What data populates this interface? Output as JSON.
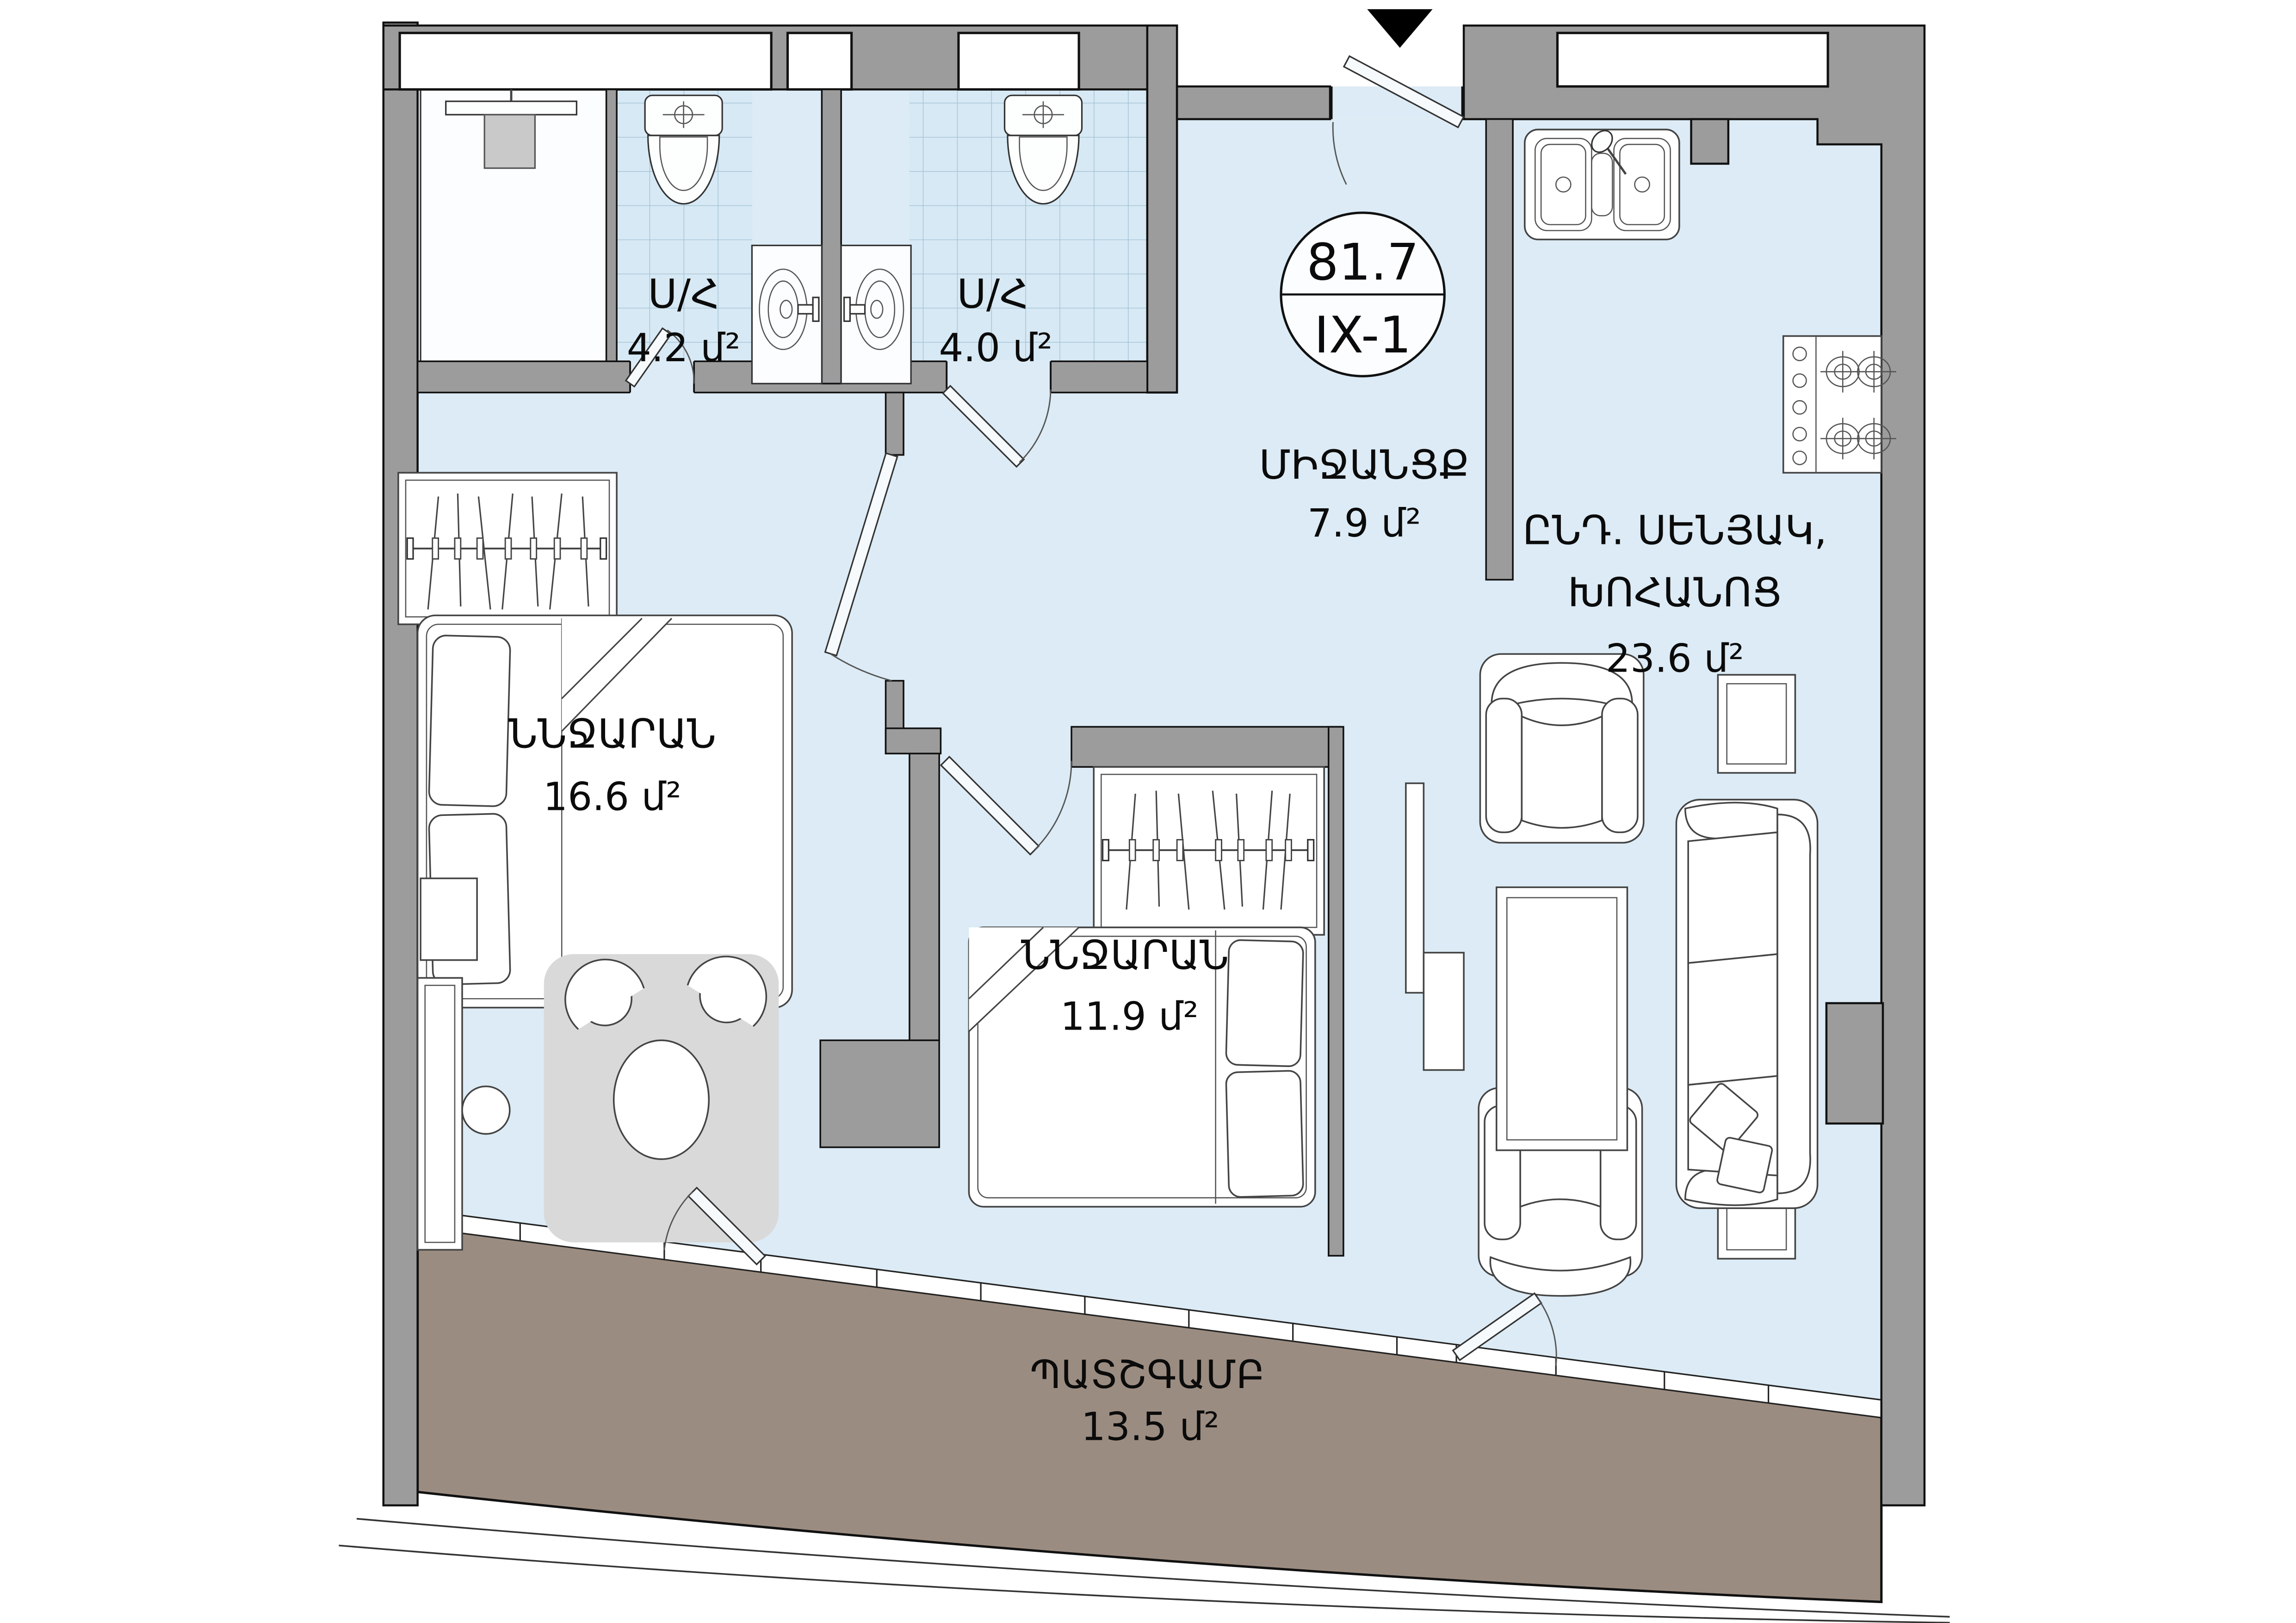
{
  "plan": {
    "type": "apartment-floor-plan",
    "language": "Armenian",
    "badge": {
      "total_area": "81.7",
      "unit_id": "IX-1"
    },
    "rooms": {
      "bathroom_1": {
        "name": "Ս/Հ",
        "area": "4.2 մ²"
      },
      "bathroom_2": {
        "name": "Ս/Հ",
        "area": "4.0 մ²"
      },
      "hallway": {
        "name": "ՄԻՋԱՆՑՔ",
        "area": "7.9 մ²"
      },
      "living_kitchen": {
        "name_line1": "ԸՆԴ. ՍԵՆՅԱԿ,",
        "name_line2": "ԽՈՀԱՆՈՑ",
        "area": "23.6 մ²"
      },
      "bedroom_1": {
        "name": "ՆՆՋԱՐԱՆ",
        "area": "16.6 մ²"
      },
      "bedroom_2": {
        "name": "ՆՆՋԱՐԱՆ",
        "area": "11.9 մ²"
      },
      "balcony": {
        "name": "ՊԱՏՇԳԱՄԲ",
        "area": "13.5 մ²"
      }
    },
    "colors": {
      "wall": "#9c9c9c",
      "floor": "#dcebf5",
      "bathroom_tile": "#d7e9f4",
      "balcony_floor": "#9b8c81",
      "rug": "#d9d9d9",
      "entrance_marker": "#000000"
    },
    "icons": [
      "entrance-arrow-icon",
      "toilet-icon",
      "bathroom-sink-icon",
      "shower-icon",
      "kitchen-sink-icon",
      "stove-icon",
      "wardrobe-hangers-icon",
      "double-bed-icon",
      "sofa-icon",
      "armchair-icon",
      "coffee-table-icon",
      "side-table-icon",
      "round-table-icon",
      "chair-icon",
      "stool-icon",
      "dresser-icon",
      "door-icon"
    ]
  }
}
